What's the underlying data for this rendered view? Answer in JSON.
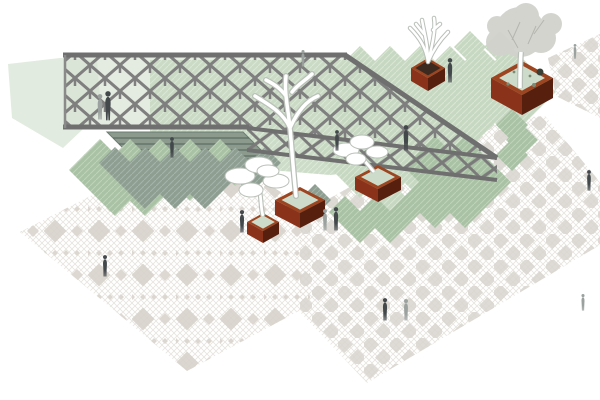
{
  "scene": {
    "title": "Plaza axonometric diagram",
    "description": "Axonometric architectural diagram of a public plaza: diagrid lattice pergola with edge truss, stepped sunken court, sage-green tile fields, corten steel tree planters and pedestrian figures on ornamental diamond paving",
    "view": "axonometric",
    "visible_text": ""
  },
  "palette": {
    "background": "#ffffff",
    "lattice_gray": "#7f7f7f",
    "chord_gray": "#6f6f6f",
    "green_wash": "#dbe6d6",
    "green_light": "#c7d8c2",
    "green_mid": "#a9c1a4",
    "green_gray": "#8e9e91",
    "court_green": "#8c9a8e",
    "court_stripe": "#5e6d63",
    "paving_fine": "#e7e4de",
    "paving_mid": "#d8d3cb",
    "corten_light": "#8a331a",
    "corten_dark": "#571f0e",
    "corten_rim": "#9c4520",
    "planter_soil": "#cddcca",
    "tree_white": "#ffffff",
    "tree_outline": "#b9c0b8",
    "tree_gray": "#d2d2cd",
    "figure_dark": "#43484b",
    "figure_light": "#9aa19f"
  },
  "elements": {
    "pergola": {
      "name": "lattice pergola canopy",
      "structure": "diagonal diagrid roof with descending edge truss",
      "people_under": 3
    },
    "sunken_court": {
      "name": "stepped sunken court",
      "steps": 4
    },
    "planters": [
      {
        "id": "A",
        "size": "large",
        "location": "upper-right",
        "tree": "leafy gray tree"
      },
      {
        "id": "B",
        "size": "small",
        "location": "top-center",
        "tree": "bare white branches"
      },
      {
        "id": "C",
        "size": "large",
        "location": "center",
        "tree": "tall bare white tree"
      },
      {
        "id": "D",
        "size": "small",
        "location": "center-left",
        "tree": "cloud-pruned white tree"
      },
      {
        "id": "E",
        "size": "medium",
        "location": "center-right",
        "tree": "cloud-pruned white tree"
      }
    ],
    "green_fields": {
      "count": 8,
      "pattern": "diagonal hatched tile diamonds"
    },
    "paving": {
      "ornamental_zone": "south-west",
      "checker_zone": "east",
      "pattern": "diamond mosaic"
    },
    "figures": {
      "count": 16,
      "style": "silhouette"
    }
  }
}
